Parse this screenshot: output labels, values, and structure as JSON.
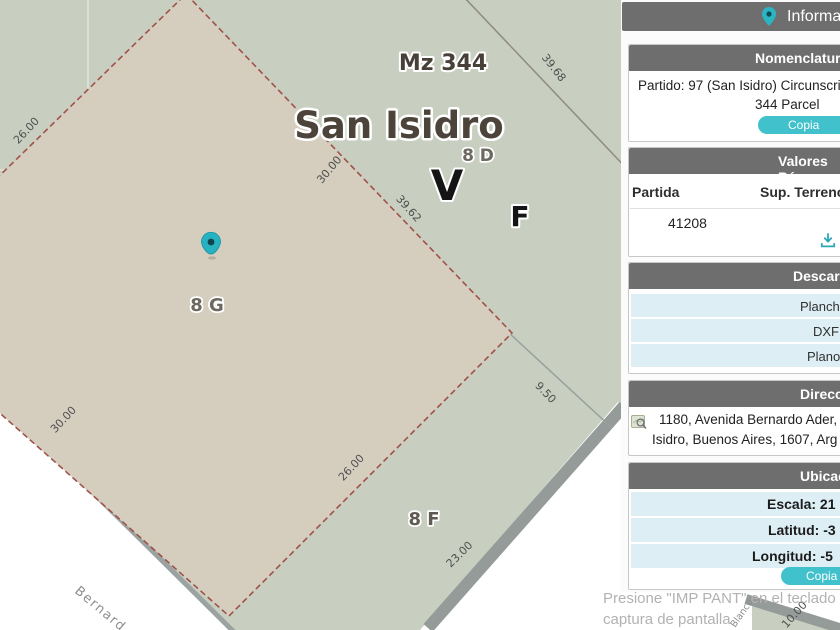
{
  "map": {
    "labels": {
      "block": "Mz 344",
      "city": "San Isidro",
      "lot_8d": "8 D",
      "zone_v": "V",
      "zone_f": "F",
      "lot_8g": "8 G",
      "lot_8f": "8 F"
    },
    "measurements": {
      "nw": "26.00",
      "upper": "30.00",
      "diag_ne": "39.62",
      "ne": "39.68",
      "west": "30.00",
      "se_inner": "26.00",
      "east": "9.50",
      "south": "23.00",
      "corner": "10.00"
    },
    "streets": {
      "sw": "Bernard",
      "se": "Blanco"
    },
    "colors": {
      "selected_parcel_fill": "#d5cdbe",
      "parcel_fill": "#c8cec0",
      "parcel_boundary_red": "#a0524a",
      "road_edge_gray": "#949b99",
      "pin_teal": "#26b2c0"
    }
  },
  "sidebar": {
    "title": "Informa",
    "colors": {
      "panel_header_gray": "#6e6e6e",
      "accent_teal": "#41c1cb",
      "highlight_row_blue": "#ddeff4"
    },
    "nomenclatura": {
      "header": "Nomenclatura",
      "line1": "Partido: 97 (San Isidro) Circunscri",
      "line2": "344 Parcel",
      "copy_button": "Copia"
    },
    "valores": {
      "header": "Valores Bá",
      "col1": "Partida",
      "col2": "Sup. Terreno",
      "partida_value": "41208"
    },
    "descargas": {
      "header": "Descarg",
      "items": [
        "Planche",
        "DXF",
        "Plano"
      ]
    },
    "direccion": {
      "header": "Direcci",
      "line1": "1180, Avenida Bernardo Ader,",
      "line2": "Isidro, Buenos Aires, 1607, Arg"
    },
    "ubicacion": {
      "header": "Ubicaci",
      "escala": "Escala: 21",
      "latitud": "Latitud: -3",
      "longitud": "Longitud: -5",
      "copy_button": "Copia"
    }
  },
  "footer": {
    "line1": "Presione \"IMP PANT\" en el teclado",
    "line2": "captura de pantalla"
  }
}
